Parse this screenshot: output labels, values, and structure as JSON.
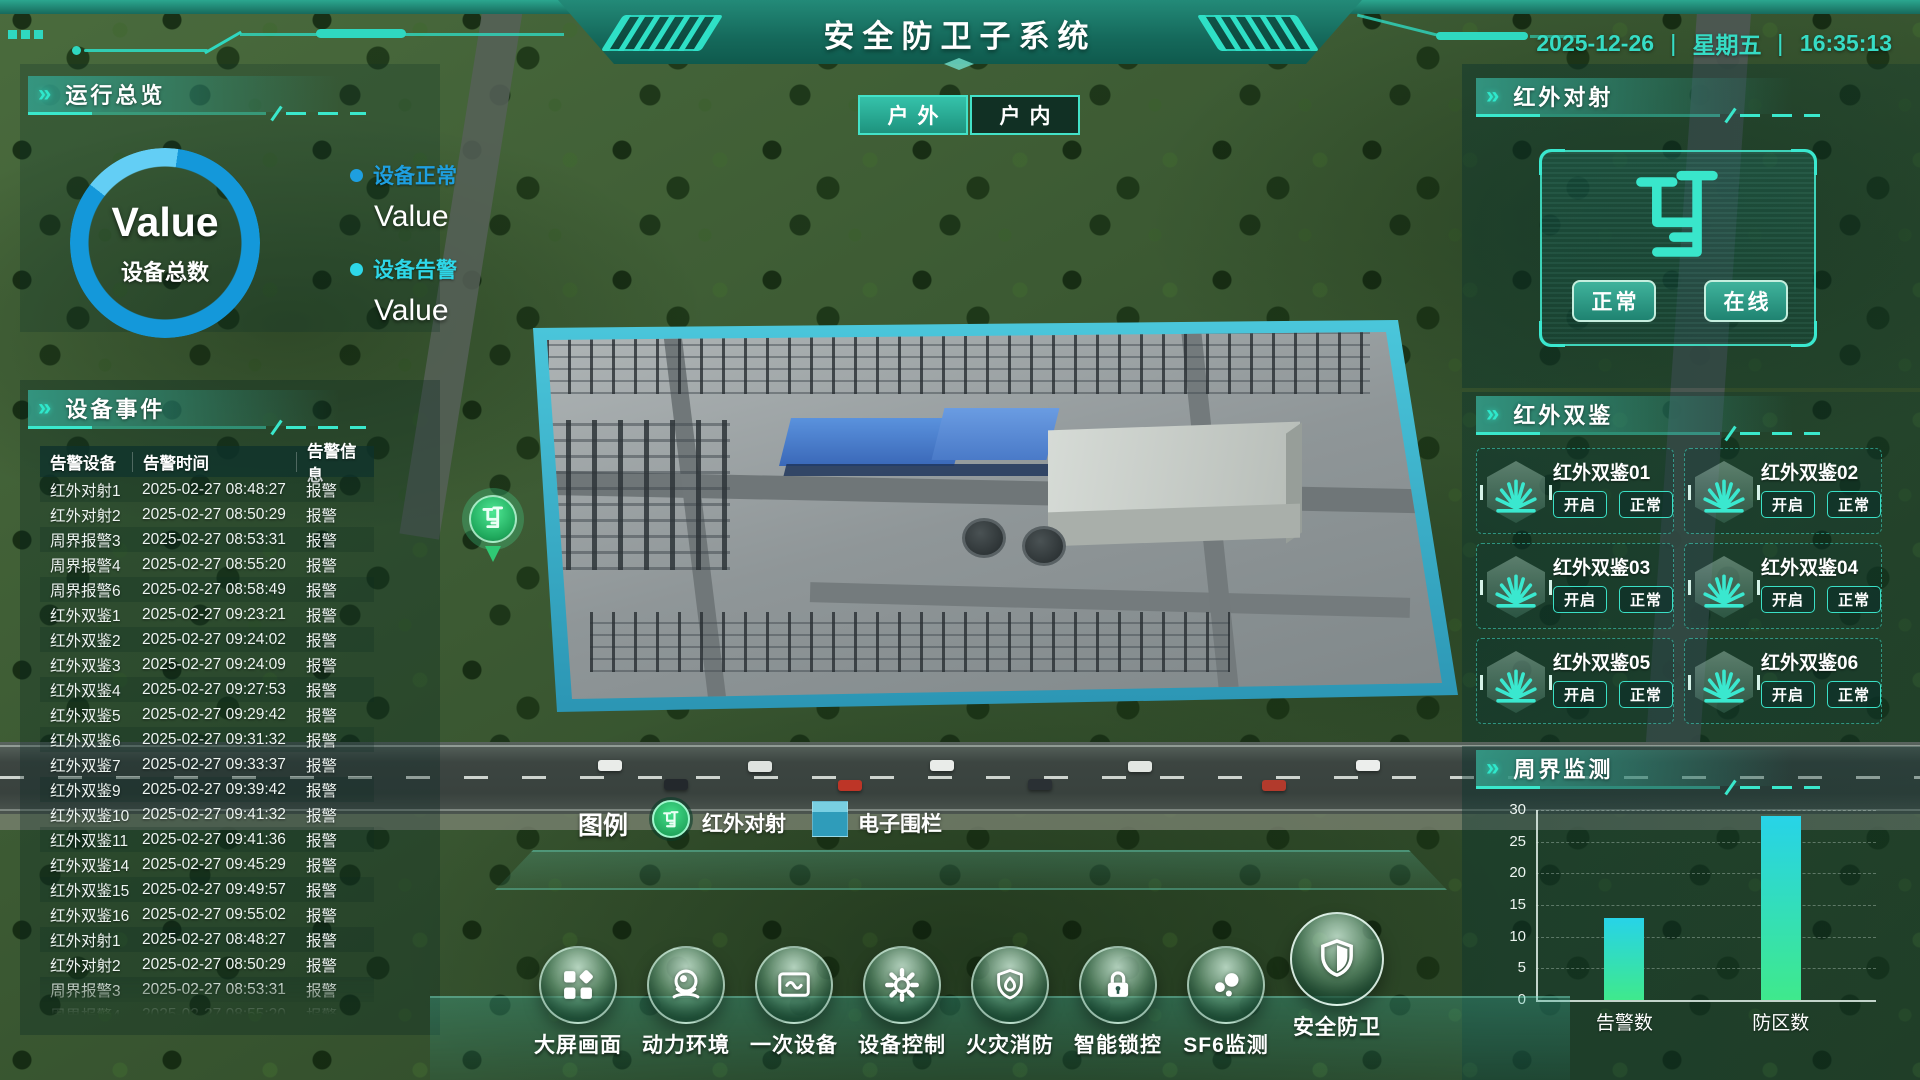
{
  "header": {
    "title": "安全防卫子系统",
    "date": "2025-12-26",
    "weekday": "星期五",
    "time": "16:35:13",
    "sep": "|"
  },
  "tabs": [
    {
      "label": "户外",
      "active": true
    },
    {
      "label": "户内",
      "active": false
    }
  ],
  "overview": {
    "title": "运行总览",
    "gauge_value": "Value",
    "gauge_label": "设备总数",
    "stats": [
      {
        "label": "设备正常",
        "value": "Value",
        "color": "#1E9FE0"
      },
      {
        "label": "设备告警",
        "value": "Value",
        "color": "#2ED7E8"
      }
    ]
  },
  "events": {
    "title": "设备事件",
    "columns": [
      "告警设备",
      "告警时间",
      "告警信息"
    ],
    "rows": [
      [
        "红外对射1",
        "2025-02-27 08:48:27",
        "报警"
      ],
      [
        "红外对射2",
        "2025-02-27 08:50:29",
        "报警"
      ],
      [
        "周界报警3",
        "2025-02-27 08:53:31",
        "报警"
      ],
      [
        "周界报警4",
        "2025-02-27 08:55:20",
        "报警"
      ],
      [
        "周界报警6",
        "2025-02-27 08:58:49",
        "报警"
      ],
      [
        "红外双鉴1",
        "2025-02-27 09:23:21",
        "报警"
      ],
      [
        "红外双鉴2",
        "2025-02-27 09:24:02",
        "报警"
      ],
      [
        "红外双鉴3",
        "2025-02-27 09:24:09",
        "报警"
      ],
      [
        "红外双鉴4",
        "2025-02-27 09:27:53",
        "报警"
      ],
      [
        "红外双鉴5",
        "2025-02-27 09:29:42",
        "报警"
      ],
      [
        "红外双鉴6",
        "2025-02-27 09:31:32",
        "报警"
      ],
      [
        "红外双鉴7",
        "2025-02-27 09:33:37",
        "报警"
      ],
      [
        "红外双鉴9",
        "2025-02-27 09:39:42",
        "报警"
      ],
      [
        "红外双鉴10",
        "2025-02-27 09:41:32",
        "报警"
      ],
      [
        "红外双鉴11",
        "2025-02-27 09:41:36",
        "报警"
      ],
      [
        "红外双鉴14",
        "2025-02-27 09:45:29",
        "报警"
      ],
      [
        "红外双鉴15",
        "2025-02-27 09:49:57",
        "报警"
      ],
      [
        "红外双鉴16",
        "2025-02-27 09:55:02",
        "报警"
      ],
      [
        "红外对射1",
        "2025-02-27 08:48:27",
        "报警"
      ],
      [
        "红外对射2",
        "2025-02-27 08:50:29",
        "报警"
      ],
      [
        "周界报警3",
        "2025-02-27 08:53:31",
        "报警"
      ],
      [
        "周界报警4",
        "2025-02-27 08:55:20",
        "报警"
      ]
    ]
  },
  "beam": {
    "title": "红外对射",
    "buttons": [
      "正常",
      "在线"
    ]
  },
  "dual": {
    "title": "红外双鉴",
    "button_labels": [
      "开启",
      "正常"
    ],
    "items": [
      "红外双鉴01",
      "红外双鉴02",
      "红外双鉴03",
      "红外双鉴04",
      "红外双鉴05",
      "红外双鉴06"
    ]
  },
  "perimeter": {
    "title": "周界监测"
  },
  "chart_data": {
    "type": "bar",
    "title": "周界监测",
    "categories": [
      "告警数",
      "防区数"
    ],
    "values": [
      13,
      29
    ],
    "xlabel": "",
    "ylabel": "",
    "ylim": [
      0,
      30
    ],
    "yticks": [
      0,
      5,
      10,
      15,
      20,
      25,
      30
    ],
    "grid": true,
    "legend_position": "none",
    "bar_gradient": [
      "#27D3E8",
      "#3FE98C"
    ]
  },
  "legend": {
    "title": "图例",
    "items": [
      {
        "label": "红外对射",
        "icon": "beam-pin"
      },
      {
        "label": "电子围栏",
        "icon": "fence-swatch"
      }
    ]
  },
  "nav": [
    {
      "label": "大屏画面",
      "icon": "grid",
      "active": false
    },
    {
      "label": "动力环境",
      "icon": "camera",
      "active": false
    },
    {
      "label": "一次设备",
      "icon": "frame",
      "active": false
    },
    {
      "label": "设备控制",
      "icon": "gear",
      "active": false
    },
    {
      "label": "火灾消防",
      "icon": "fire",
      "active": false
    },
    {
      "label": "智能锁控",
      "icon": "lock",
      "active": false
    },
    {
      "label": "SF6监测",
      "icon": "sf6",
      "active": false
    },
    {
      "label": "安全防卫",
      "icon": "shield",
      "active": true
    }
  ],
  "colors": {
    "accent": "#35E0C6",
    "header": "#1B7A6A",
    "normal_blue": "#1E9FE0",
    "alarm_cyan": "#2ED7E8",
    "gauge_ring": "#1598DA",
    "gauge_segment": "#5FCCF4",
    "bar_top": "#27D3E8",
    "bar_bottom": "#3FE98C"
  }
}
